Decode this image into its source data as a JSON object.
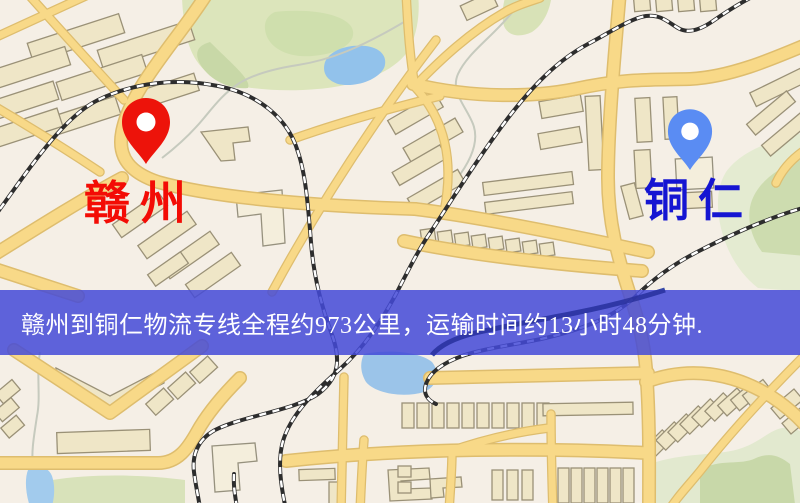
{
  "banner": {
    "text": "赣州到铜仁物流专线全程约973公里，运输时间约13小时48分钟.",
    "background_color": "#4a4ad3",
    "text_color": "#ffffff"
  },
  "route": {
    "origin": "赣州",
    "destination": "铜仁",
    "distance": "约973公里",
    "duration": "约13小时48分钟"
  },
  "markers": {
    "origin": {
      "name": "赣州",
      "label_color": "#f30c05",
      "pin_color": "#e8140c",
      "pin_style": "red-pin"
    },
    "destination": {
      "name": "铜仁",
      "label_color": "#1515d2",
      "pin_color": "#5b8cf0",
      "pin_style": "blue-pin"
    }
  },
  "map": {
    "theme_colors": {
      "background": "#f5efe6",
      "road_fill": "#f7d98a",
      "road_casing": "#ddbd70",
      "building_fill": "#efe6c8",
      "building_stroke": "#9a9178",
      "green_area": "#dce5bc",
      "green_dark": "#cbdba6",
      "water": "#9cc4e8",
      "railway": "#2d2d2d"
    }
  }
}
